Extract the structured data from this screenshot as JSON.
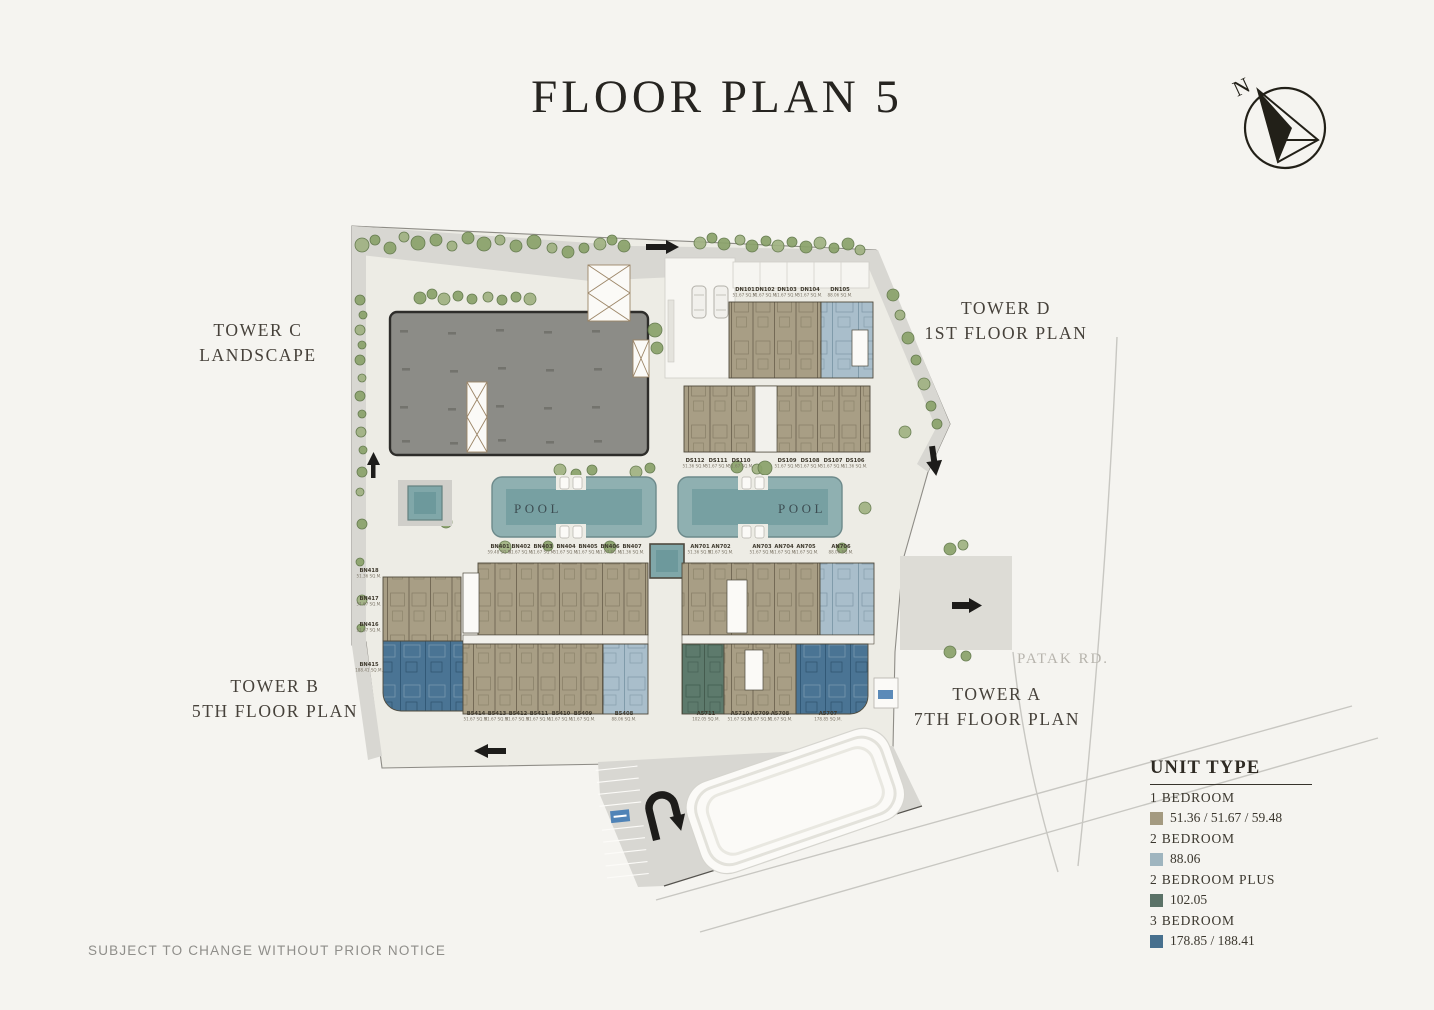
{
  "title": "FLOOR PLAN 5",
  "compass": {
    "north": "N"
  },
  "towers": {
    "c": {
      "line1": "TOWER C",
      "line2": "LANDSCAPE"
    },
    "d": {
      "line1": "TOWER D",
      "line2": "1ST FLOOR PLAN"
    },
    "b": {
      "line1": "TOWER B",
      "line2": "5TH FLOOR PLAN"
    },
    "a": {
      "line1": "TOWER A",
      "line2": "7TH FLOOR PLAN"
    }
  },
  "pool_label": "POOL",
  "roads": {
    "patak": "PATAK RD.",
    "taina": "TAINA RD."
  },
  "disclaimer": "SUBJECT TO CHANGE WITHOUT PRIOR NOTICE",
  "legend": {
    "title": "UNIT TYPE",
    "items": [
      {
        "label": "1 BEDROOM",
        "value": "51.36 / 51.67 / 59.48",
        "color": "#a49a80"
      },
      {
        "label": "2 BEDROOM",
        "value": "88.06",
        "color": "#9fb5bf"
      },
      {
        "label": "2 BEDROOM PLUS",
        "value": "102.05",
        "color": "#5b7267"
      },
      {
        "label": "3 BEDROOM",
        "value": "178.85 / 188.41",
        "color": "#47708e"
      }
    ]
  },
  "units": {
    "tower_d_north": [
      {
        "name": "DN101",
        "area": "51.67 SQ.M."
      },
      {
        "name": "DN102",
        "area": "51.67 SQ.M."
      },
      {
        "name": "DN103",
        "area": "51.67 SQ.M."
      },
      {
        "name": "DN104",
        "area": "51.67 SQ.M."
      },
      {
        "name": "DN105",
        "area": "88.06 SQ.M."
      }
    ],
    "tower_d_south": [
      {
        "name": "DS112",
        "area": "51.36 SQ.M."
      },
      {
        "name": "DS111",
        "area": "51.67 SQ.M."
      },
      {
        "name": "DS110",
        "area": "51.67 SQ.M."
      },
      {
        "name": "DS109",
        "area": "51.67 SQ.M."
      },
      {
        "name": "DS108",
        "area": "51.67 SQ.M."
      },
      {
        "name": "DS107",
        "area": "51.67 SQ.M."
      },
      {
        "name": "DS106",
        "area": "51.36 SQ.M."
      }
    ],
    "tower_b_north": [
      {
        "name": "BN401",
        "area": "59.48 SQ.M."
      },
      {
        "name": "BN402",
        "area": "51.67 SQ.M."
      },
      {
        "name": "BN403",
        "area": "51.67 SQ.M."
      },
      {
        "name": "BN404",
        "area": "51.67 SQ.M."
      },
      {
        "name": "BN405",
        "area": "51.67 SQ.M."
      },
      {
        "name": "BN406",
        "area": "51.67 SQ.M."
      },
      {
        "name": "BN407",
        "area": "51.36 SQ.M."
      }
    ],
    "tower_a_north": [
      {
        "name": "AN701",
        "area": "51.36 SQ.M."
      },
      {
        "name": "AN702",
        "area": "51.67 SQ.M."
      },
      {
        "name": "AN703",
        "area": "51.67 SQ.M."
      },
      {
        "name": "AN704",
        "area": "51.67 SQ.M."
      },
      {
        "name": "AN705",
        "area": "51.67 SQ.M."
      },
      {
        "name": "AN706",
        "area": "88.06 SQ.M."
      }
    ],
    "tower_b_west": [
      {
        "name": "BN418",
        "area": "51.36 SQ.M."
      },
      {
        "name": "BN417",
        "area": "51.67 SQ.M."
      },
      {
        "name": "BN416",
        "area": "51.67 SQ.M."
      },
      {
        "name": "BN415",
        "area": "188.41 SQ.M."
      }
    ],
    "tower_b_south": [
      {
        "name": "B5414",
        "area": "51.67 SQ.M."
      },
      {
        "name": "B5413",
        "area": "51.67 SQ.M."
      },
      {
        "name": "B5412",
        "area": "51.67 SQ.M."
      },
      {
        "name": "B5411",
        "area": "51.67 SQ.M."
      },
      {
        "name": "B5410",
        "area": "51.67 SQ.M."
      },
      {
        "name": "B5409",
        "area": "51.67 SQ.M."
      },
      {
        "name": "B5408",
        "area": "88.06 SQ.M."
      }
    ],
    "tower_a_south": [
      {
        "name": "A5711",
        "area": "102.05 SQ.M."
      },
      {
        "name": "A5710",
        "area": "51.67 SQ.M."
      },
      {
        "name": "A5709",
        "area": "51.67 SQ.M."
      },
      {
        "name": "A5708",
        "area": "51.67 SQ.M."
      },
      {
        "name": "A5707",
        "area": "178.85 SQ.M."
      }
    ]
  }
}
